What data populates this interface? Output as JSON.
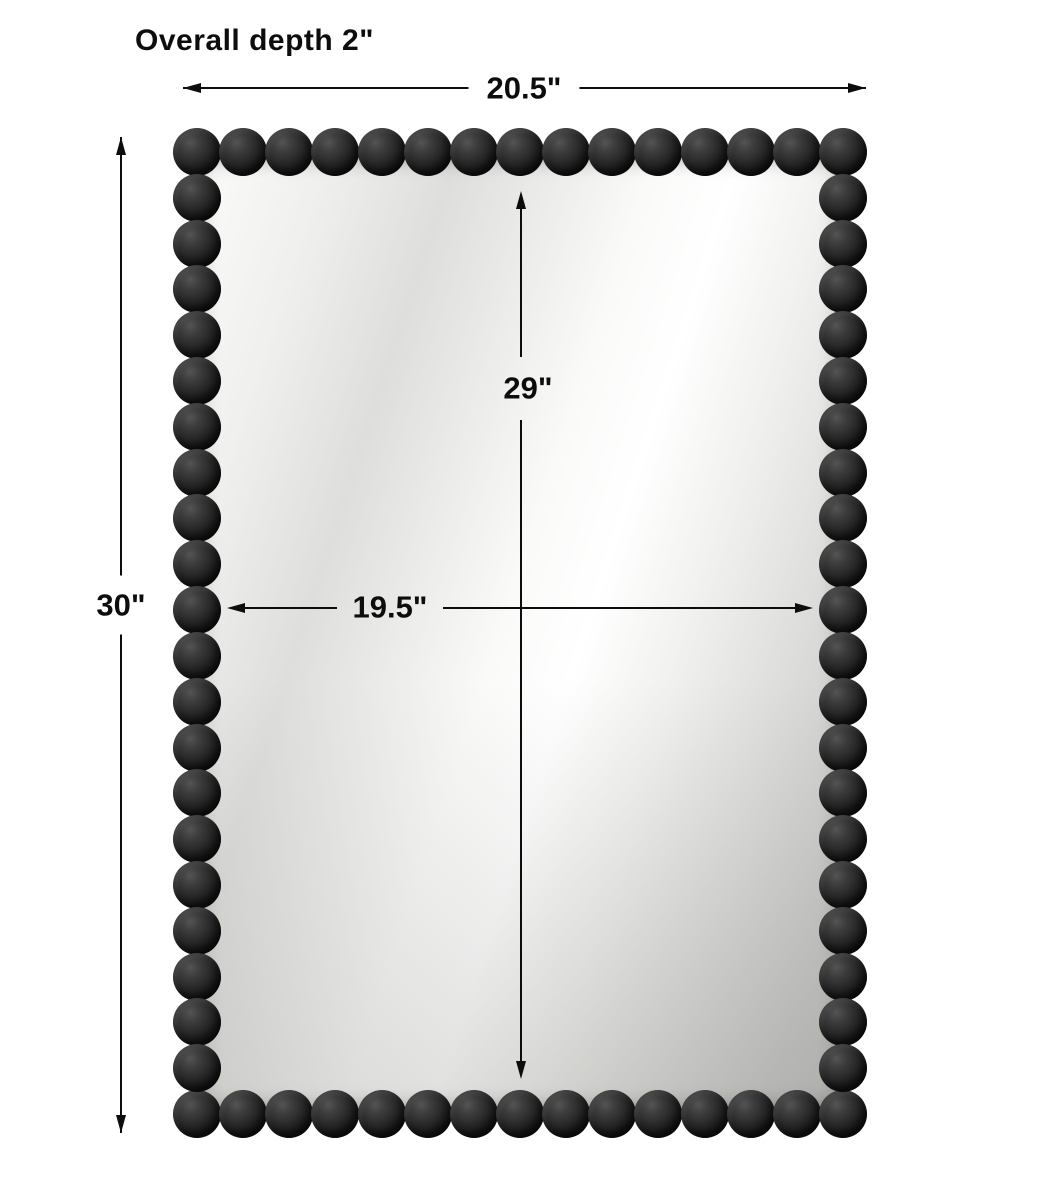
{
  "diagram": {
    "type": "product-dimensions",
    "subject": "rectangular beaded-frame mirror",
    "depth_note": "Overall depth 2\"",
    "dimensions": {
      "overall_width": "20.5\"",
      "overall_height": "30\"",
      "mirror_height": "29\"",
      "mirror_width": "19.5\""
    }
  },
  "colors": {
    "dimension_line": "#0d0d0d",
    "bead": "#1c1c1c",
    "background": "#ffffff"
  }
}
